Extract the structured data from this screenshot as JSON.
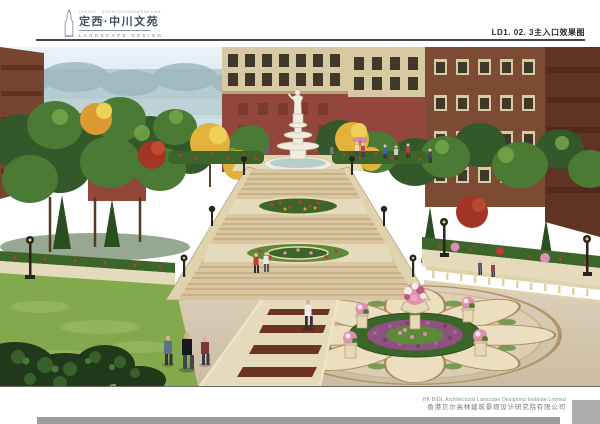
{
  "header": {
    "logo": {
      "tower_icon": "tower-outline-icon",
      "micro_text": "DINGXI · ZHONGCHUANWENYUAN",
      "title": "定西·中川文苑",
      "subtitle": "LANDSCAPE DESIGN"
    },
    "sheet_code": "LD1. 02. 3主入口效果图"
  },
  "rendering": {
    "alt": "主入口景观效果图：中轴大台阶与花坛跌级、欧式雕塑喷泉、圆形花钵广场铺装、秋色银杏红枫与绿树、红砖住宅楼、行人"
  },
  "footer": {
    "company_en": "HK BIGL Architectural Lanscape Designing Institute Limited",
    "company_zh": "香港贝尔高林建筑景观设计研究院有限公司"
  },
  "colors": {
    "sky_top": "#eaf3f7",
    "sky_bottom": "#cadee8",
    "mist": "#afc6cd",
    "mist_dark": "#9cb5bd",
    "building_brown": "#77452f",
    "building_dark": "#613324",
    "brick": "#93473a",
    "building_cream": "#d9c9a2",
    "window_dark": "#41382c",
    "building_right": "#7d4a33",
    "foliage_dark": "#33592a",
    "foliage_mid": "#4a7a34",
    "foliage_light": "#76a649",
    "conifer": "#2b4d22",
    "ginkgo_yellow": "#e2b33b",
    "ginkgo_light": "#f1d057",
    "ginkgo_orange": "#de9a32",
    "maple_red": "#a23524",
    "stone_step": "#d9c6a0",
    "stone_riser": "#b49c72",
    "stone_wall": "#e0d2ac",
    "hedge": "#3c6629",
    "hedge_light": "#5c8a38",
    "flower_red": "#c13a3a",
    "flower_pink": "#df8fb0",
    "flower_purple": "#8f5180",
    "paving": "#d3c5ad",
    "paving_band": "#e6dabc",
    "paving_inlay": "#6d3424",
    "medallion_line": "#b1946a",
    "lawn": "#82a94c",
    "statue_white": "#f1ece0",
    "shrub_dark": "#20391b",
    "water": "#b7cdc9",
    "planter_stone": "#e6d9b8",
    "footer_bar": "#9d9d9d",
    "footer_block": "#adadad"
  }
}
